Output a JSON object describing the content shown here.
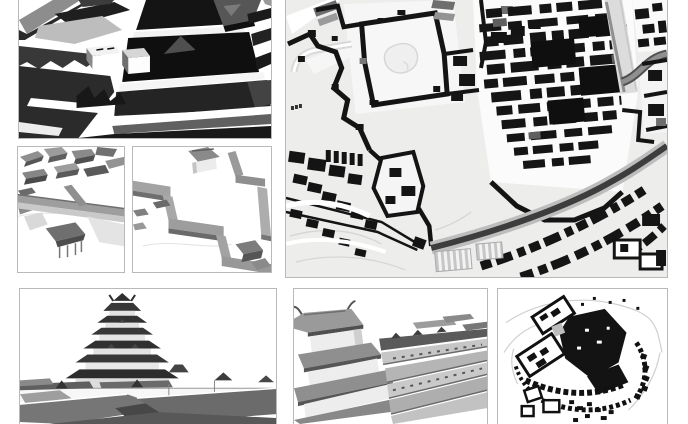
{
  "page": {
    "title": "Castle reconstruction collage",
    "background": "#ffffff",
    "panel_border": "#b9b9b9",
    "description": "Grayscale collage: six 3D castle-town reconstruction renders and two figure-ground maps, arranged in two rows on a white background."
  },
  "panels": {
    "keep_closeup": {
      "label": "Dark 3D render: close-up of the multi-tier castle keep with surrounding roofs and walls"
    },
    "town_aerial_left": {
      "label": "Light 3D render: aerial view of castle-town houses, a diagonal wall street and a covered gate shelter"
    },
    "walls_aerial_right": {
      "label": "Light 3D render: aerial view of zig-zag roofed castle walls and corridors"
    },
    "castle_map_large": {
      "label": "Axonometric figure-ground map of the castle town: black buildings and walls, pond courtyard, curving moat, striped stalls"
    },
    "tower_elevation": {
      "label": "Side elevation render of the six-tier castle tower rising above town walls and foreground roofs"
    },
    "rooftop_view": {
      "label": "3D render looking from the tiered corner tower across long parallel rooftops"
    },
    "castle_map_small": {
      "label": "Small figure-ground plan of the castle complex: dense black core, ringed enclosures and house rows"
    }
  },
  "palette": {
    "render_black": "#141414",
    "render_dark_gray": "#2e2e2e",
    "render_mid_gray": "#6e6e6e",
    "render_light_gray": "#c4c4c4",
    "wall_white": "#f6f6f6",
    "map_ground": "#ededec",
    "map_building_black": "#151515",
    "map_moat_gray": "#3d3d3d",
    "map_road_gray": "#8f8f8f"
  }
}
